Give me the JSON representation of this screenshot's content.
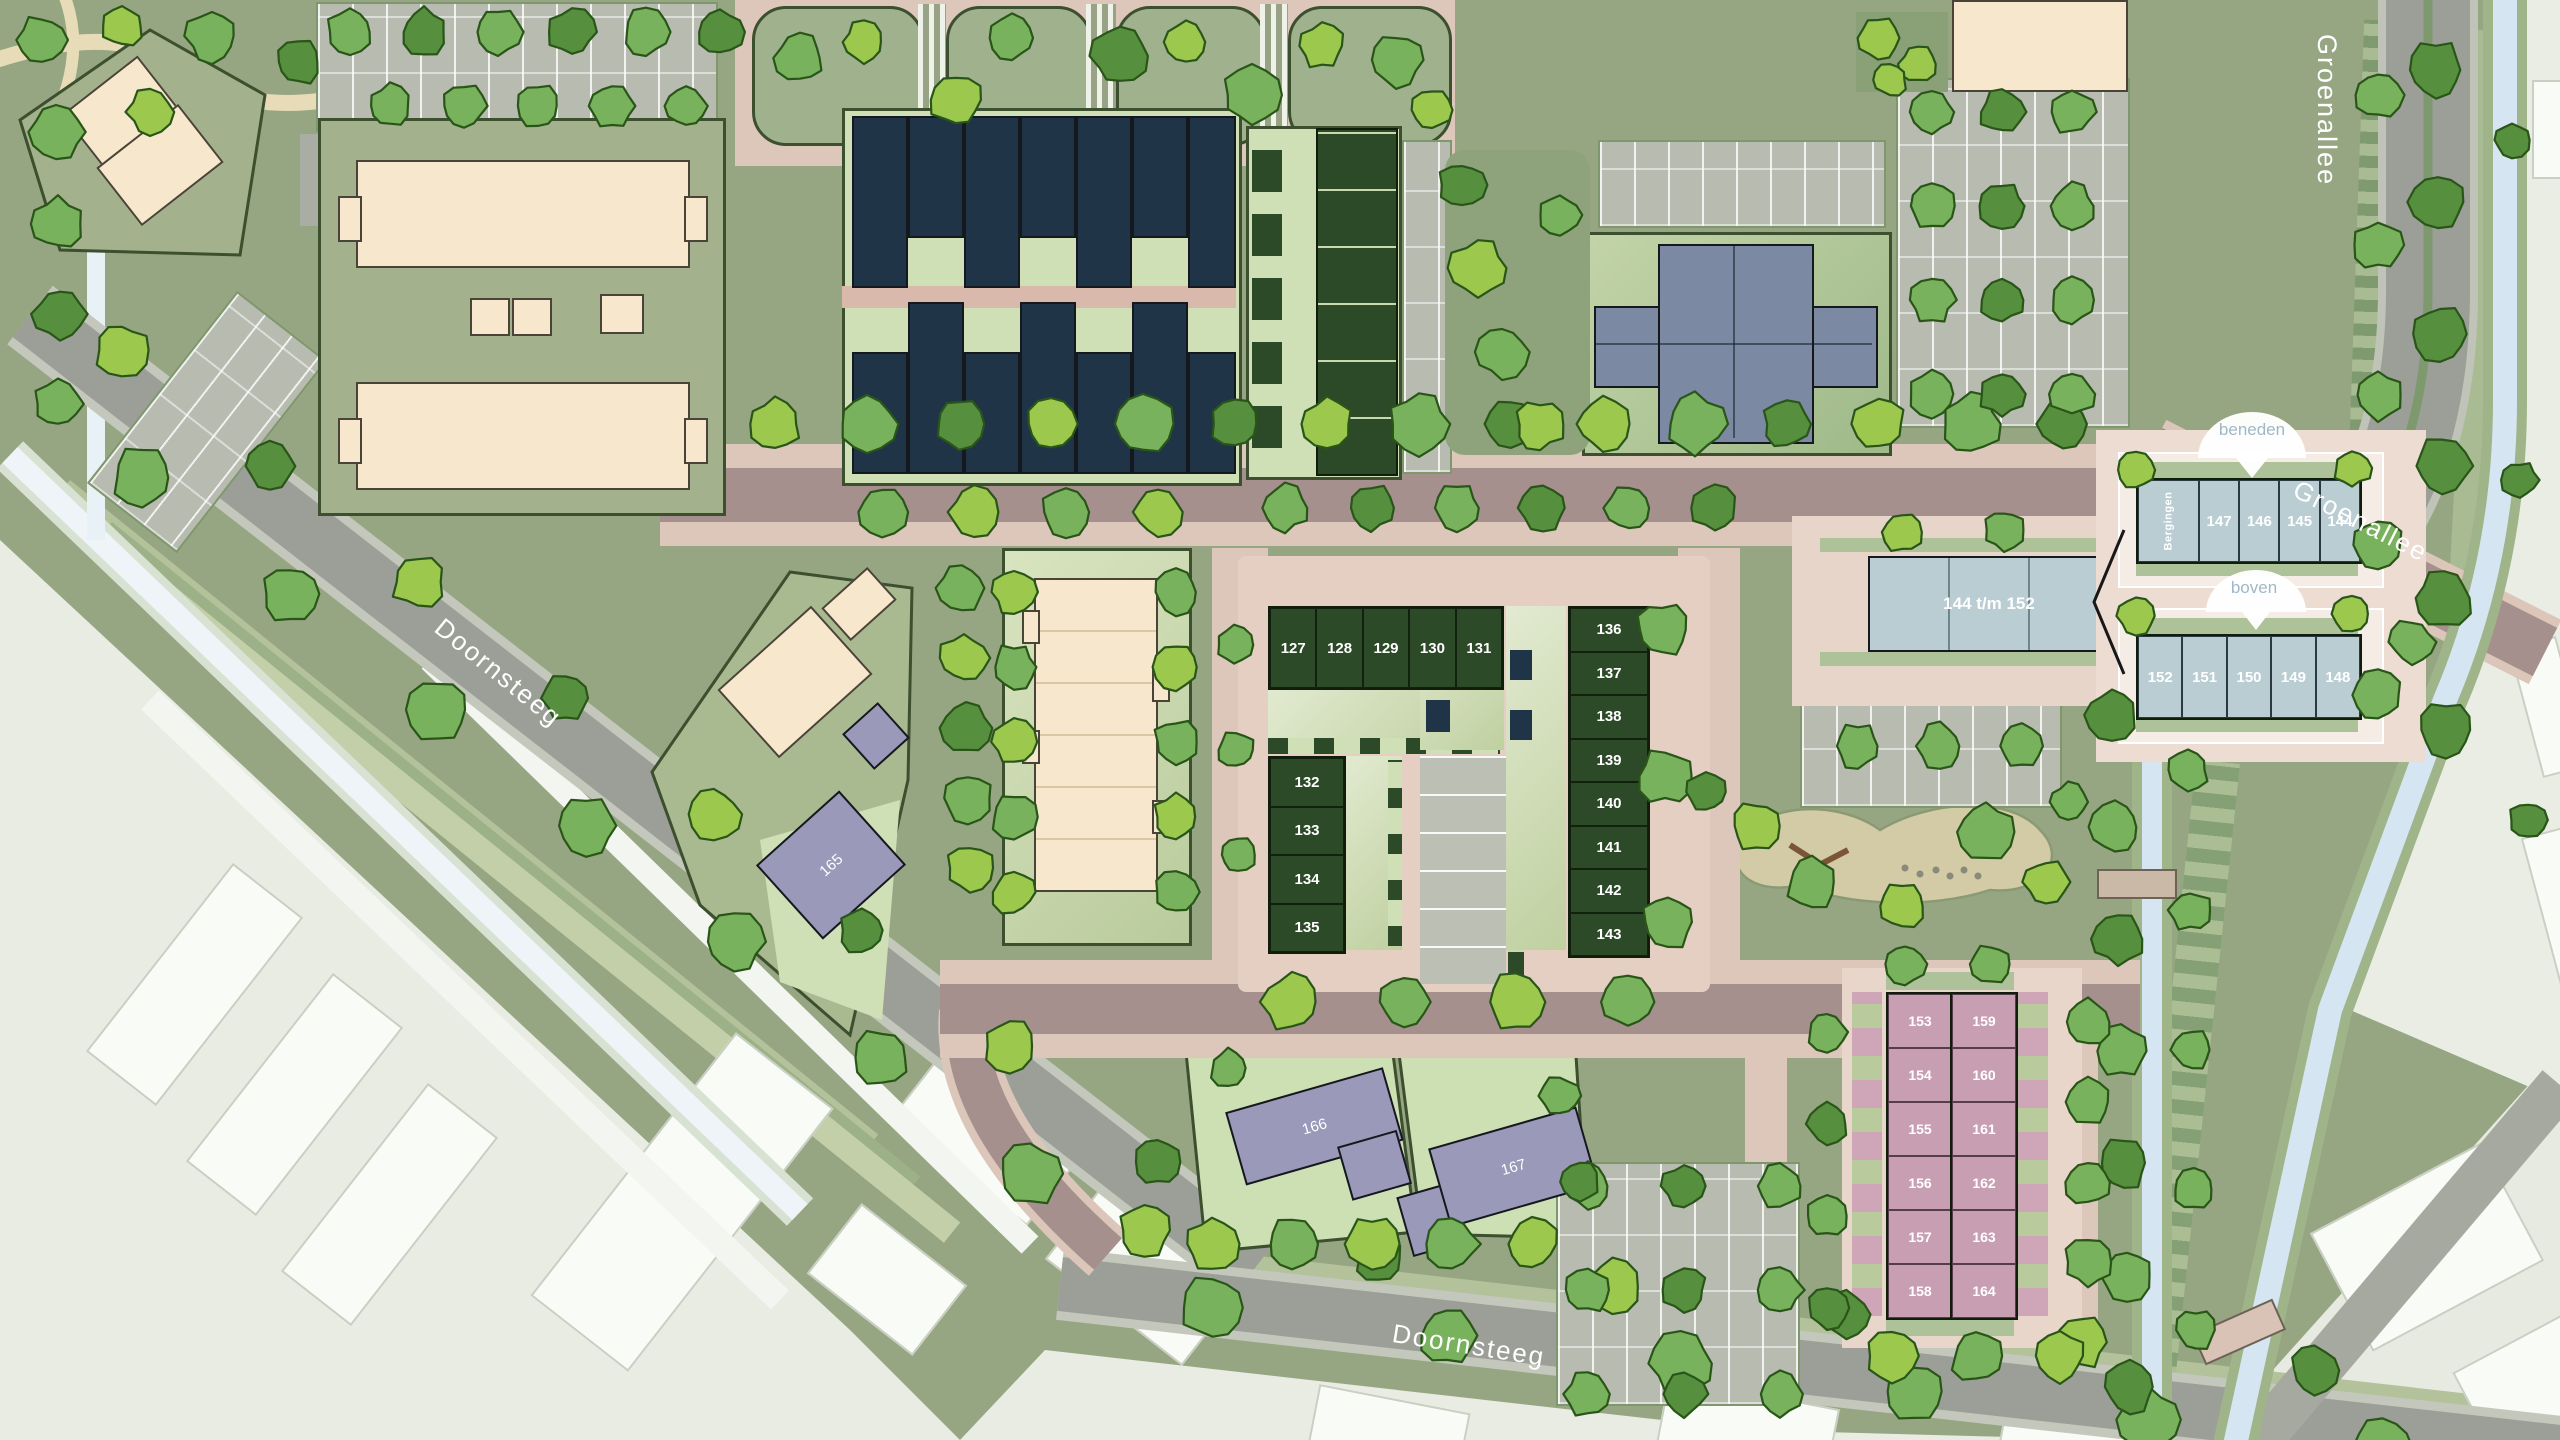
{
  "streets": {
    "groenallee_vertical": "Groenallee",
    "groenallee_diagonal": "Groenallee",
    "doornsteeg_left": "Doornsteeg",
    "doornsteeg_bottom": "Doornsteeg"
  },
  "callouts": {
    "beneden": "beneden",
    "boven": "boven"
  },
  "plots": {
    "row_127_131": [
      "127",
      "128",
      "129",
      "130",
      "131"
    ],
    "col_132_135": [
      "132",
      "133",
      "134",
      "135"
    ],
    "col_136_143": [
      "136",
      "137",
      "138",
      "139",
      "140",
      "141",
      "142",
      "143"
    ],
    "beneden_units": [
      "Bergingen",
      "147",
      "146",
      "145",
      "144"
    ],
    "boven_units": [
      "152",
      "151",
      "150",
      "149",
      "148"
    ],
    "apartments_left": [
      "153",
      "154",
      "155",
      "156",
      "157",
      "158"
    ],
    "apartments_right": [
      "159",
      "160",
      "161",
      "162",
      "163",
      "164"
    ],
    "house_165": "165",
    "house_166": "166",
    "house_167": "167"
  },
  "buildings": {
    "slab_label": "144 t/m 152"
  },
  "colors": {
    "development_ground": "#97a682",
    "existing_faded": "#e9ece3",
    "road_gray": "#9b9f97",
    "road_mauve": "#a5908e",
    "road_pink": "#ddc7bb",
    "building_navy": "#1f3547",
    "building_darkgreen": "#2d4a28",
    "building_blue": "#b9cdd2",
    "building_cross": "#7b89a3",
    "building_pink": "#c89fb2",
    "building_purple": "#9b99b9",
    "building_cream": "#f6e7cd",
    "water": "#d6e5f2",
    "tree_green": "#79b25c"
  }
}
